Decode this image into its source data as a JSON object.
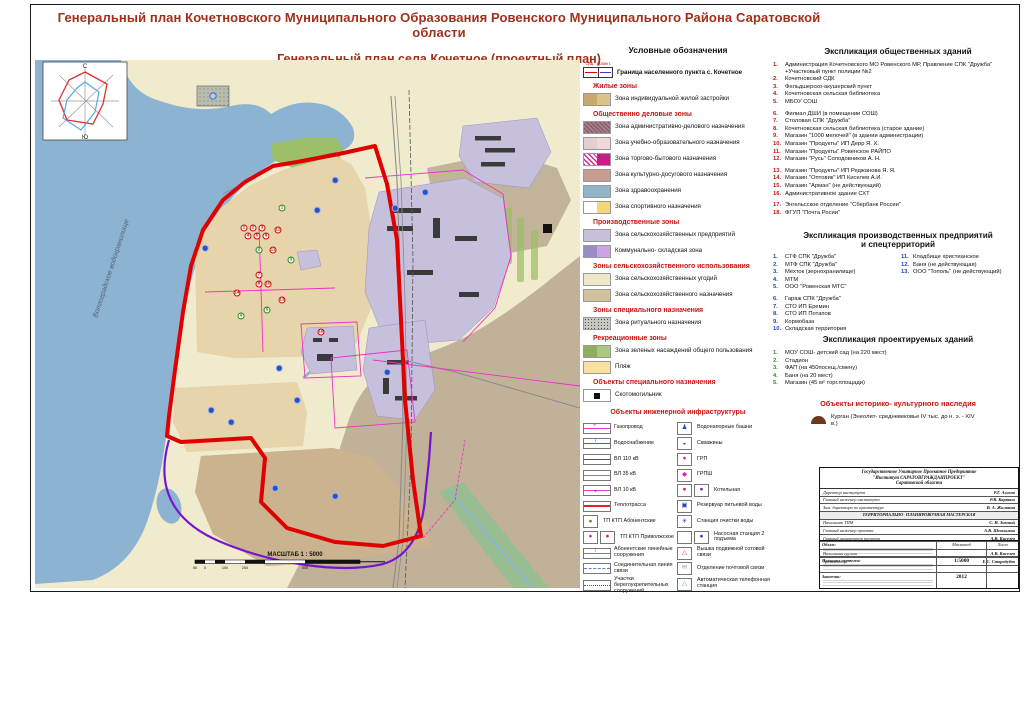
{
  "colors": {
    "title": "#A0301A",
    "heading": "#CC1111",
    "water": "#8DB3D2",
    "land": "#F1EBCE",
    "village": "#E7D4AB",
    "industrial": "#C6C0DD",
    "agro": "#C2B199",
    "garden": "#CBB390",
    "green": "#9CBF68",
    "red": "#E00000",
    "magenta": "#EE30C8",
    "purple": "#7715CC"
  },
  "title": {
    "line1": "Генеральный план Кочетновского Муниципального Образования Ровенского Муниципального Района Саратовской области",
    "line2": "Генеральный план села Кочетное (проектный план)"
  },
  "map": {
    "water_label": "Волгоградское водохранилище",
    "scale_caption": "МАСШТАБ 1 : 5000",
    "scalebar_labels": [
      "50",
      "0",
      "100",
      "200",
      "500"
    ],
    "compass_n": "С",
    "compass_s": "Ю",
    "markers_red": [
      {
        "n": "1",
        "x": 209,
        "y": 168
      },
      {
        "n": "2",
        "x": 218,
        "y": 168
      },
      {
        "n": "3",
        "x": 227,
        "y": 168
      },
      {
        "n": "4",
        "x": 213,
        "y": 176
      },
      {
        "n": "5",
        "x": 222,
        "y": 176
      },
      {
        "n": "9",
        "x": 231,
        "y": 176
      },
      {
        "n": "12",
        "x": 243,
        "y": 170
      },
      {
        "n": "11",
        "x": 238,
        "y": 190
      },
      {
        "n": "7",
        "x": 224,
        "y": 215
      },
      {
        "n": "8",
        "x": 224,
        "y": 224
      },
      {
        "n": "10",
        "x": 233,
        "y": 224
      },
      {
        "n": "13",
        "x": 247,
        "y": 240
      },
      {
        "n": "14",
        "x": 202,
        "y": 233
      },
      {
        "n": "16",
        "x": 286,
        "y": 272
      }
    ],
    "markers_green": [
      {
        "n": "1",
        "x": 247,
        "y": 148
      },
      {
        "n": "2",
        "x": 224,
        "y": 190
      },
      {
        "n": "3",
        "x": 256,
        "y": 200
      },
      {
        "n": "4",
        "x": 206,
        "y": 256
      },
      {
        "n": "5",
        "x": 232,
        "y": 250
      }
    ],
    "markers_blue": [
      {
        "x": 170,
        "y": 188
      },
      {
        "x": 282,
        "y": 150
      },
      {
        "x": 300,
        "y": 120
      },
      {
        "x": 360,
        "y": 148
      },
      {
        "x": 390,
        "y": 132
      },
      {
        "x": 244,
        "y": 308
      },
      {
        "x": 176,
        "y": 350
      },
      {
        "x": 240,
        "y": 428
      },
      {
        "x": 300,
        "y": 436
      },
      {
        "x": 352,
        "y": 312
      },
      {
        "x": 196,
        "y": 362
      },
      {
        "x": 262,
        "y": 340
      }
    ]
  },
  "legend": {
    "title": "Условные обозначения",
    "boundary": {
      "existing": "сущ.",
      "project": "проект.",
      "label": "Граница населенного пункта с. Кочетное"
    },
    "entries": [
      {
        "heading": "Жилые зоны"
      },
      {
        "label": "Зона индивидуальной жилой застройки",
        "c1": "#C9A96B",
        "c2": "#DCC38C"
      },
      {
        "heading": "Общественно деловые зоны"
      },
      {
        "label": "Зона административно-делового назначения",
        "c1": "#A87E88",
        "c2": "#A87E88",
        "cls": "pat-diag"
      },
      {
        "label": "Зона учебно-образовательного назначения",
        "c1": "#E6CDCF",
        "c2": "#EDD9D9"
      },
      {
        "label": "Зона торгово-бытового назначения",
        "c1": "#FFFFFF",
        "c2": "#C81C86",
        "cls": "pat-trade"
      },
      {
        "label": "Зона культурно-досугового назначения",
        "c1": "#C99C90",
        "c2": "#C99C90"
      },
      {
        "label": "Зона здравоохранения",
        "c1": "#93B5C9",
        "c2": "#93B5C9"
      },
      {
        "label": "Зона спортивного назначения",
        "c1": "#FFFFFF",
        "c2": "#F3D878"
      },
      {
        "heading": "Производственные зоны"
      },
      {
        "label": "Зона сельскохозяйственных предприятий",
        "c1": "#C6C0DD",
        "c2": "#C6C0DD"
      },
      {
        "label": "Коммунально- складская зона",
        "c1": "#9D8BC5",
        "c2": "#CBA3E6"
      },
      {
        "heading": "Зоны сельскохозяйственного использования"
      },
      {
        "label": "Зона сельскохозяйственных угодий",
        "c1": "#F0E7C9",
        "c2": "#F0E7C9"
      },
      {
        "label": "Зона сельскохозяйственного назначения",
        "c1": "#CFC29C",
        "c2": "#CFC29C"
      },
      {
        "heading": "Зоны специального назначения"
      },
      {
        "label": "Зона ритуального назначения",
        "c1": "#C6C8C0",
        "c2": "#C6C8C0",
        "cls": "pat-dots"
      },
      {
        "heading": "Рекреационные зоны"
      },
      {
        "label": "Зона зеленых насаждений общего пользования",
        "c1": "#8FAE60",
        "c2": "#ABC781"
      },
      {
        "label": "Пляж",
        "c1": "#F8E09E",
        "c2": "#F8E09E"
      },
      {
        "heading": "Объекты специального назначения"
      },
      {
        "label": "Скотомогильник",
        "c1": "#FFFFFF",
        "c2": "#FFFFFF",
        "cls": "pat-blacksq"
      }
    ],
    "infra_heading": "Объекты инженерной инфраструктуры",
    "infra_left": [
      {
        "label": "Газопровод",
        "lc": "#E23FD0",
        "ls": "ln-gas"
      },
      {
        "label": "Водоснабжение",
        "lc": "#4A62C8",
        "ls": "ln-tick"
      },
      {
        "label": "ВЛ 110 кВ",
        "lc": "#555555",
        "ls": "ln-plain"
      },
      {
        "label": "ВЛ 35 кВ",
        "lc": "#8A8A8A",
        "ls": "ln-plain"
      },
      {
        "label": "ВЛ 10 кВ",
        "lc": "#E23FD0",
        "ls": "ln-arrow"
      },
      {
        "label": "Теплотрасса",
        "lc": "#E02525",
        "ls": "ln-thick"
      },
      {
        "label": "ТП КТП Абонентские",
        "g1": "●",
        "gc1": "#7A7A20"
      },
      {
        "label": "ТП КТП Приволжское",
        "g1": "●",
        "gc1": "#CC22CC",
        "g2": "●",
        "gc2": "#CC2222"
      },
      {
        "label": "Абонентские линейные сооружения",
        "lc": "#5B7FD4",
        "ls": "ln-tick"
      },
      {
        "label": "Соединительная линия связи",
        "lc": "#5B7FD4",
        "ls": "ln-dash"
      },
      {
        "label": "Участки берегоукрепительных сооружений",
        "lc": "#336655",
        "ls": "ln-dot"
      }
    ],
    "infra_right": [
      {
        "label": "Водонапорные башни",
        "g1": "♟",
        "gc1": "#2244BB"
      },
      {
        "label": "Скважины",
        "g1": "◒",
        "gc1": "#2244BB"
      },
      {
        "label": "ГРП",
        "g1": "●",
        "gc1": "#E020C0"
      },
      {
        "label": "ГРПШ",
        "g1": "◆",
        "gc1": "#E020C0"
      },
      {
        "label": "Котельная",
        "g1": "●",
        "gc1": "#DD2222",
        "g2": "●",
        "gc2": "#7722AA"
      },
      {
        "label": "Резервуар питьевой воды",
        "g1": "▣",
        "gc1": "#2244BB"
      },
      {
        "label": "Станция очистки воды",
        "g1": "✳",
        "gc1": "#2244BB"
      },
      {
        "label": "Насосная станция 2 подъема",
        "g1": "",
        "g2": "●",
        "gc2": "#2233CC"
      },
      {
        "label": "Вышка подвижной сотовой связи",
        "g1": "△",
        "gc1": "#CC3333"
      },
      {
        "label": "Отделение почтовой связи",
        "g1": "✉",
        "gc1": "#999999"
      },
      {
        "label": "Автоматическая телефонная станция",
        "g1": "△",
        "gc1": "#44AAAA"
      }
    ]
  },
  "public": {
    "title": "Экспликация общественных зданий",
    "items": [
      {
        "n": "1.",
        "t": "Администрация Кочетновского МО Ровенского МР, Правление СПК \"Дружба\" +Участковый пункт полиции №2"
      },
      {
        "n": "2.",
        "t": "Кочетновский СДК"
      },
      {
        "n": "3.",
        "t": "Фельдшерско-акушерский пункт"
      },
      {
        "n": "4.",
        "t": "Кочетновская сельская библиотека"
      },
      {
        "n": "5.",
        "t": "МБОУ СОШ"
      },
      {
        "n": "6.",
        "t": "Филиал ДШИ (в помещении СОШ)",
        "cls": "gap"
      },
      {
        "n": "7.",
        "t": "Столовая СПК \"Дружба\""
      },
      {
        "n": "8.",
        "t": "Кочетновская сельская библиотека (старое здание)"
      },
      {
        "n": "9.",
        "t": "Магазин \"1000 мелочей\" (в здании администрации)"
      },
      {
        "n": "10.",
        "t": "Магазин \"Продукты\" ИП Дерр Я. Х."
      },
      {
        "n": "11.",
        "t": "Магазин \"Продукты\" Ровенское РАЙПО"
      },
      {
        "n": "12.",
        "t": "Магазин \"Русь\" Солодовников А. Н."
      },
      {
        "n": "13.",
        "t": "Магазин \"Продукты\" ИП Реджанова Я. Я.",
        "cls": "gap"
      },
      {
        "n": "14.",
        "t": "Магазин \"Оптовик\" ИП Киселев А.И."
      },
      {
        "n": "15.",
        "t": "Магазин \"Арман\" (не действующий)"
      },
      {
        "n": "16.",
        "t": "Административное здание СХТ"
      },
      {
        "n": "17.",
        "t": "Энгельсское отделение \"Сбербанк России\"",
        "cls": "gap"
      },
      {
        "n": "18.",
        "t": "ФГУП \"Почта Росии\""
      }
    ]
  },
  "industrial": {
    "title_l1": "Экспликация производственных предприятий",
    "title_l2": "и спецтерриторий",
    "col1": [
      {
        "n": "1.",
        "t": "СТФ СПК \"Дружба\""
      },
      {
        "n": "2.",
        "t": "МТФ СПК \"Дружба\""
      },
      {
        "n": "3.",
        "t": "Мехток (зернохранилище)"
      },
      {
        "n": "4.",
        "t": "МТМ"
      },
      {
        "n": "5.",
        "t": "ООО \"Ровенская МТС\""
      },
      {
        "n": "6.",
        "t": "Гараж СПК \"Дружба\"",
        "cls": "gap"
      },
      {
        "n": "7.",
        "t": "СТО ИП Еремин"
      },
      {
        "n": "8.",
        "t": "СТО ИП Потапов"
      },
      {
        "n": "9.",
        "t": "Кормобаза"
      },
      {
        "n": "10.",
        "t": "Складская территория"
      }
    ],
    "col2": [
      {
        "n": "11.",
        "t": "Кладбище христианское"
      },
      {
        "n": "12.",
        "t": "Баня (не действующая)"
      },
      {
        "n": "13.",
        "t": "ООО \"Тополь\" (не действующий)"
      }
    ]
  },
  "projected": {
    "title": "Экспликация проектируемых зданий",
    "items": [
      {
        "n": "1.",
        "t": "МОУ СОШ- детский сад (на 220 мест)"
      },
      {
        "n": "2.",
        "t": "Стадион"
      },
      {
        "n": "3.",
        "t": "ФАП (на 450посещ./смену)"
      },
      {
        "n": "4.",
        "t": "Баня (на 20 мест)"
      },
      {
        "n": "5.",
        "t": "Магазин (45 м² торг.площади)"
      }
    ]
  },
  "heritage": {
    "title": "Объекты историко- культурного наследия",
    "text": "Курган (Энеолит- средневековье IV тыс. до н. э. - XIV в.)"
  },
  "stamp": {
    "org1": "Государственное Унитарное Проектное Предприятие",
    "org2": "\"Институт САРАТОВГРАЖДАНПРОЕКТ\"",
    "org3": "Саратовской области",
    "rows1": [
      {
        "role": "Директор института",
        "name": "Р.Г. Ахохов"
      },
      {
        "role": "Главный инженер института",
        "name": "Р.В. Карякин"
      },
      {
        "role": "Зам. директора по архитектуре",
        "name": "В. А. Жилкина"
      }
    ],
    "band": "ТЕРРИТОРИАЛЬНО- ПЛАНИРОВОЧНАЯ МАСТЕРСКАЯ",
    "rows2": [
      {
        "role": "Начальник ТПМ",
        "name": "С. И. Зимний"
      },
      {
        "role": "Главный инженер проекта",
        "name": "А.В. Шпильман"
      },
      {
        "role": "Главный архитектор проекта",
        "name": "А.В. Киселев"
      }
    ],
    "rows3": [
      {
        "role": "Начальник группы",
        "name": "А.В. Киселев"
      },
      {
        "role": "Архитектор",
        "name": "Е.С. Стародубов"
      }
    ],
    "object_label": "Объем:",
    "drawing_label": "Название чертежа:",
    "customer_label": "Заказчик:",
    "scale_header": "Масштаб",
    "sheet_header": "Лист",
    "scale_value": "1:5000",
    "year": "2012"
  }
}
